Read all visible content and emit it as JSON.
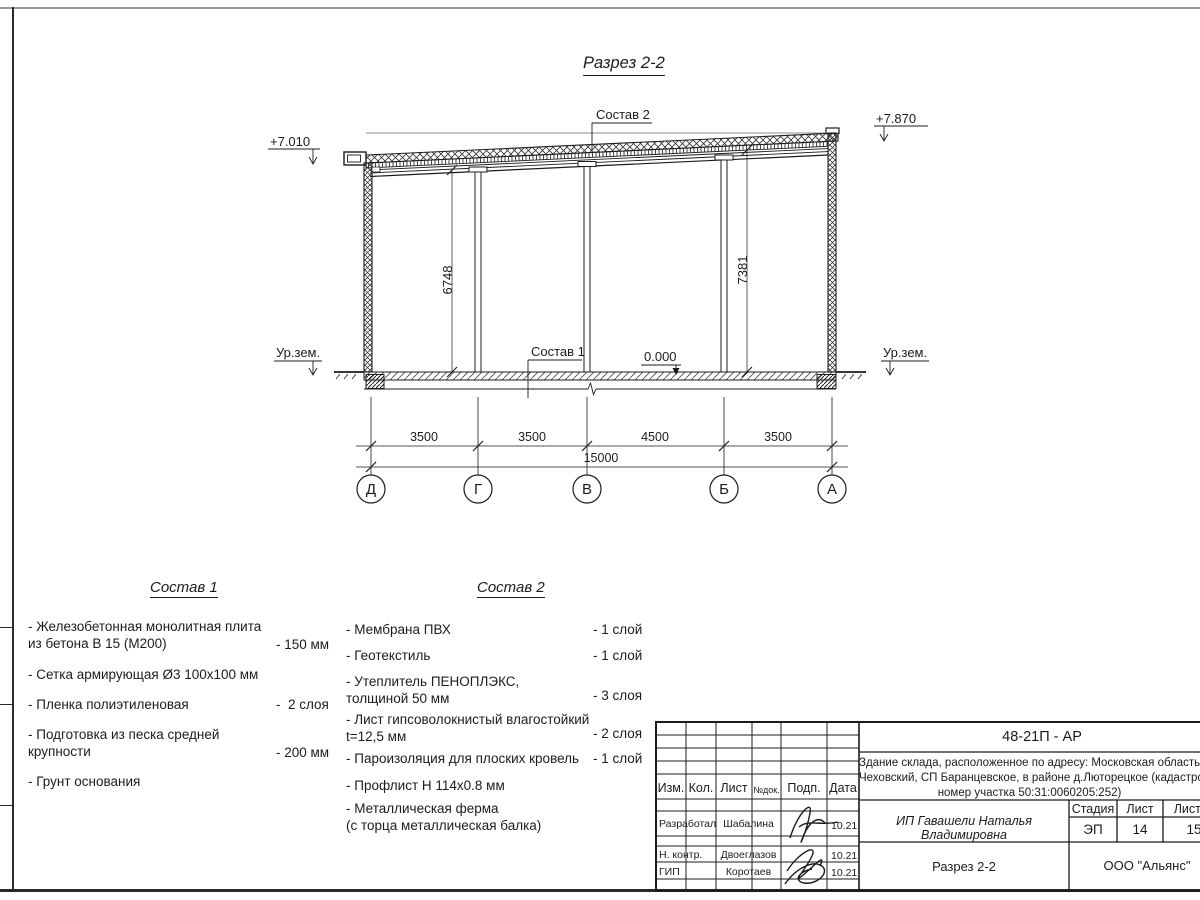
{
  "drawing": {
    "title": "Разрез 2-2",
    "labels": {
      "elev_left": "+7.010",
      "elev_right": "+7.870",
      "ground_left": "Ур.зем.",
      "ground_right": "Ур.зем.",
      "callout_roof": "Состав 2",
      "callout_floor": "Состав 1",
      "zero_level": "0.000",
      "height_left": "6748",
      "height_right": "7381"
    },
    "dims": {
      "spans": [
        "3500",
        "3500",
        "4500",
        "3500"
      ],
      "total": "15000"
    },
    "axes": [
      "Д",
      "Г",
      "В",
      "Б",
      "А"
    ]
  },
  "composition1": {
    "title": "Состав 1",
    "items": [
      {
        "text": "- Железобетонная  монолитная плита\nиз бетона В 15 (М200)",
        "value": "- 150 мм"
      },
      {
        "text": "- Сетка армирующая Ø3 100х100 мм",
        "value": ""
      },
      {
        "text": "- Пленка полиэтиленовая",
        "value": "-  2 слоя"
      },
      {
        "text": "- Подготовка из песка средней\nкрупности",
        "value": "- 200 мм"
      },
      {
        "text": "- Грунт основания",
        "value": ""
      }
    ]
  },
  "composition2": {
    "title": "Состав 2",
    "items": [
      {
        "text": "- Мембрана ПВХ",
        "value": "- 1 слой"
      },
      {
        "text": "- Геотекстиль",
        "value": "- 1 слой"
      },
      {
        "text": "- Утеплитель ПЕНОПЛЭКС,\nтолщиной 50 мм",
        "value": "- 3 слоя"
      },
      {
        "text": "- Лист гипсоволокнистый влагостойкий\nt=12,5 мм",
        "value": "- 2 слоя"
      },
      {
        "text": "- Пароизоляция для плоских кровель",
        "value": "- 1 слой"
      },
      {
        "text": "- Профлист Н 114х0.8 мм",
        "value": ""
      },
      {
        "text": "- Металлическая ферма\n(с торца металлическая балка)",
        "value": ""
      }
    ]
  },
  "titleblock": {
    "code": "48-21П - АР",
    "address_line1": "Здание склада, расположенное по адресу: Московская область, р",
    "address_line2": "Чеховский, СП Баранцевское, в районе д.Люторецкое  (кадастровы",
    "address_line3": "номер участка 50:31:0060205:252)",
    "columns": [
      "Изм.",
      "Кол.",
      "Лист",
      "№док.",
      "Подп.",
      "Дата"
    ],
    "rows": [
      {
        "role": "Разработал",
        "name": "Шабалина",
        "date": "10.21"
      },
      {
        "role": "Н. контр.",
        "name": "Двоеглазов",
        "date": "10.21"
      },
      {
        "role": "ГИП",
        "name": "Коротаев",
        "date": "10.21"
      }
    ],
    "client": "ИП Гавашели Наталья Владимировна",
    "stage_label": "Стадия",
    "sheet_label": "Лист",
    "sheets_label": "Листов",
    "stage": "ЭП",
    "sheet_num": "14",
    "sheets_total": "15",
    "view_name": "Разрез 2-2",
    "company": "ООО \"Альянс\""
  }
}
